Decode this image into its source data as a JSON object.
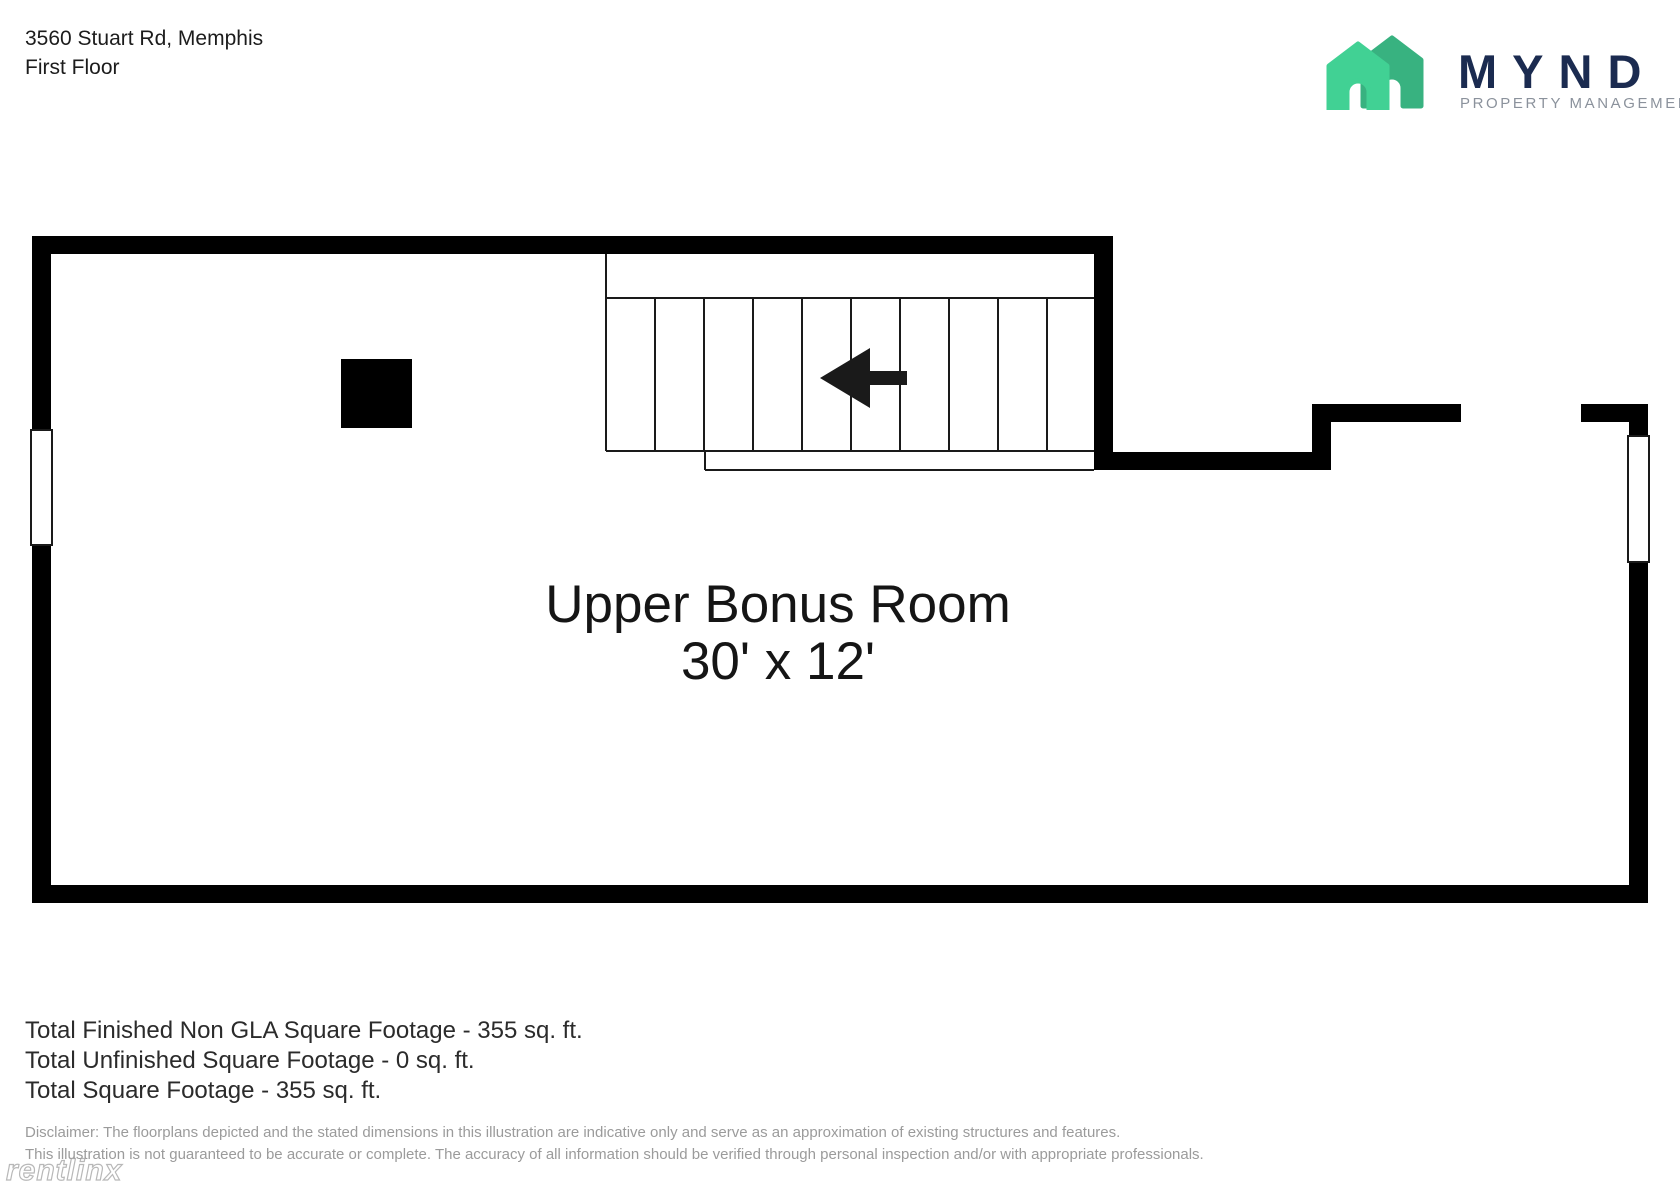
{
  "header": {
    "address": "3560 Stuart Rd, Memphis",
    "floor": "First Floor"
  },
  "logo": {
    "brand": "MYND",
    "tagline": "PROPERTY MANAGEMENT",
    "colors": {
      "house_light_green": "#41d194",
      "house_dark_green": "#38b280",
      "brand_navy": "#1b2b50",
      "tagline_gray": "#8b929c"
    }
  },
  "floorplan": {
    "room_label": "Upper Bonus Room",
    "room_dimensions": "30' x 12'",
    "wall_color": "#000000",
    "features": [
      "stairs-with-down-arrow",
      "left-window",
      "right-window",
      "chimney-black-square",
      "door-opening-top-right"
    ]
  },
  "totals": {
    "lines": [
      "Total Finished Non GLA Square Footage - 355 sq. ft.",
      "Total Unfinished Square Footage - 0 sq. ft.",
      "Total Square Footage - 355 sq. ft."
    ]
  },
  "disclaimer": {
    "line1": "Disclaimer: The floorplans depicted and the stated dimensions in this illustration are indicative only and serve as an approximation of existing structures and features.",
    "line2": "This illustration is not guaranteed to be accurate or complete. The accuracy of all information should be verified through personal inspection and/or with appropriate professionals."
  },
  "watermark": "rentlinx"
}
